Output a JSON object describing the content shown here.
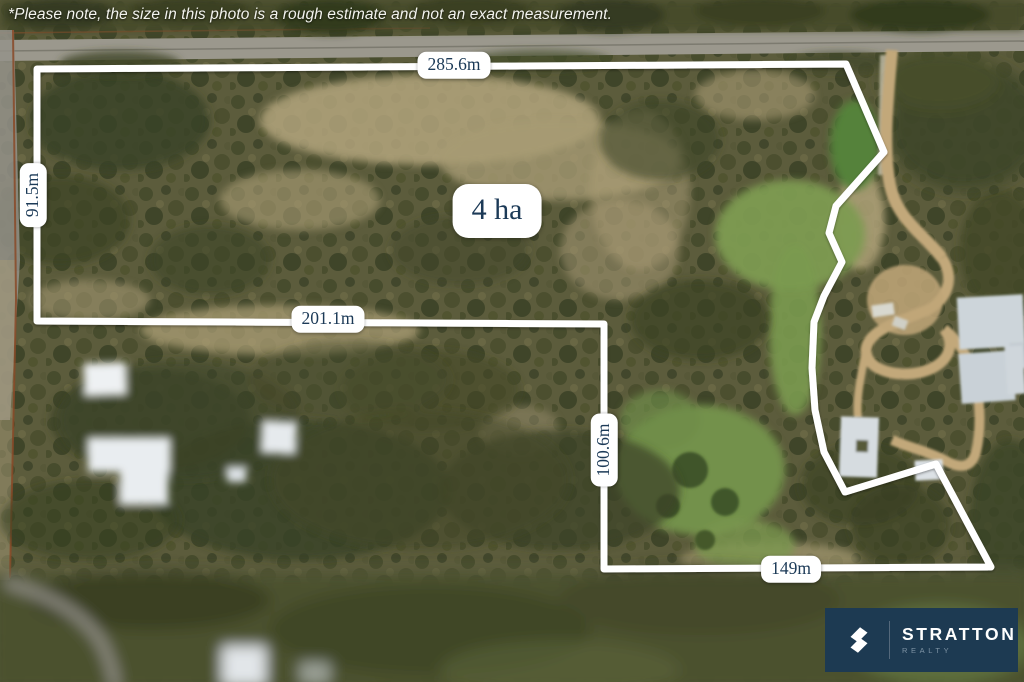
{
  "disclaimer": "*Please note, the size in this photo is a rough estimate and not an exact measurement.",
  "area_label": "4 ha",
  "measurements": {
    "top": "285.6m",
    "left": "91.5m",
    "middle": "201.1m",
    "inner_right": "100.6m",
    "bottom": "149m"
  },
  "logo": {
    "brand": "STRATTON",
    "division": "REALTY"
  },
  "colors": {
    "boundary_line": "#ffffff",
    "label_background": "#ffffff",
    "label_text": "#1c3a57",
    "logo_background": "#1d3a52",
    "logo_brand_text": "#ffffff",
    "logo_division_text": "#7e93a4"
  }
}
